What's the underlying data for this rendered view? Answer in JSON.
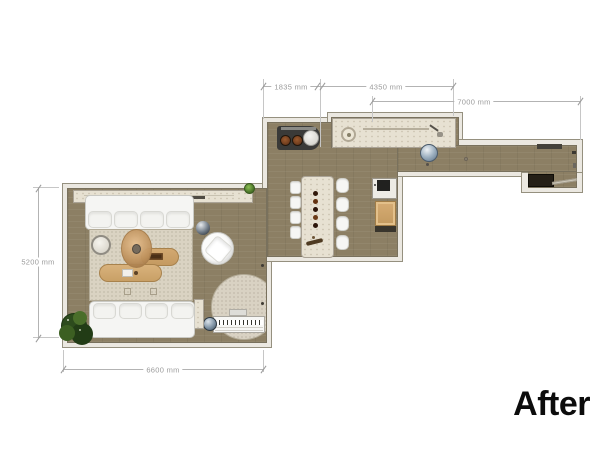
{
  "page": {
    "background": "#ffffff",
    "after_label": "After"
  },
  "dimensions": {
    "d1835": "1835 mm",
    "d4350": "4350 mm",
    "d7000": "7000 mm",
    "d5200": "5200 mm",
    "d6600": "6600 mm"
  },
  "colors": {
    "floor": "#8c7f64",
    "wall_fill": "#ebe8e1",
    "wall_edge": "#95907f",
    "stone_surfaces": "#e7e1d2",
    "area_rug": "#dad3c2",
    "upholstery": "#f5f5f3",
    "wood": "#cfa66f",
    "plant_green": "#2d4b1d",
    "pendant_sphere": "#9db0c0",
    "dimension_text": "#9b9b9b",
    "after_text": "#0c0c0c"
  },
  "rooms": {
    "living_room": {
      "furniture": [
        "tv-console",
        "console-plant",
        "sofa-top",
        "sofa-bottom",
        "area-rug",
        "round-side-table",
        "hanging-egg-chair",
        "oval-coffee-table-upper",
        "oval-coffee-table-lower",
        "swivel-armchair",
        "sphere-side-table",
        "round-rug",
        "digital-piano",
        "piano-stool",
        "floor-plant",
        "slim-side-table"
      ]
    },
    "kitchen_dining": {
      "furniture": [
        "cooktop-with-pans",
        "stone-counter-with-round-sink",
        "dining-table",
        "candle-centerpiece",
        "dining-chairs-left-4",
        "dining-chairs-right-4",
        "sink-unit",
        "wood-cabinet"
      ]
    },
    "hallway": {
      "furniture": [
        "sphere-pendant",
        "ceiling-spot",
        "wall-shelf",
        "doormat",
        "entry-door"
      ]
    }
  }
}
